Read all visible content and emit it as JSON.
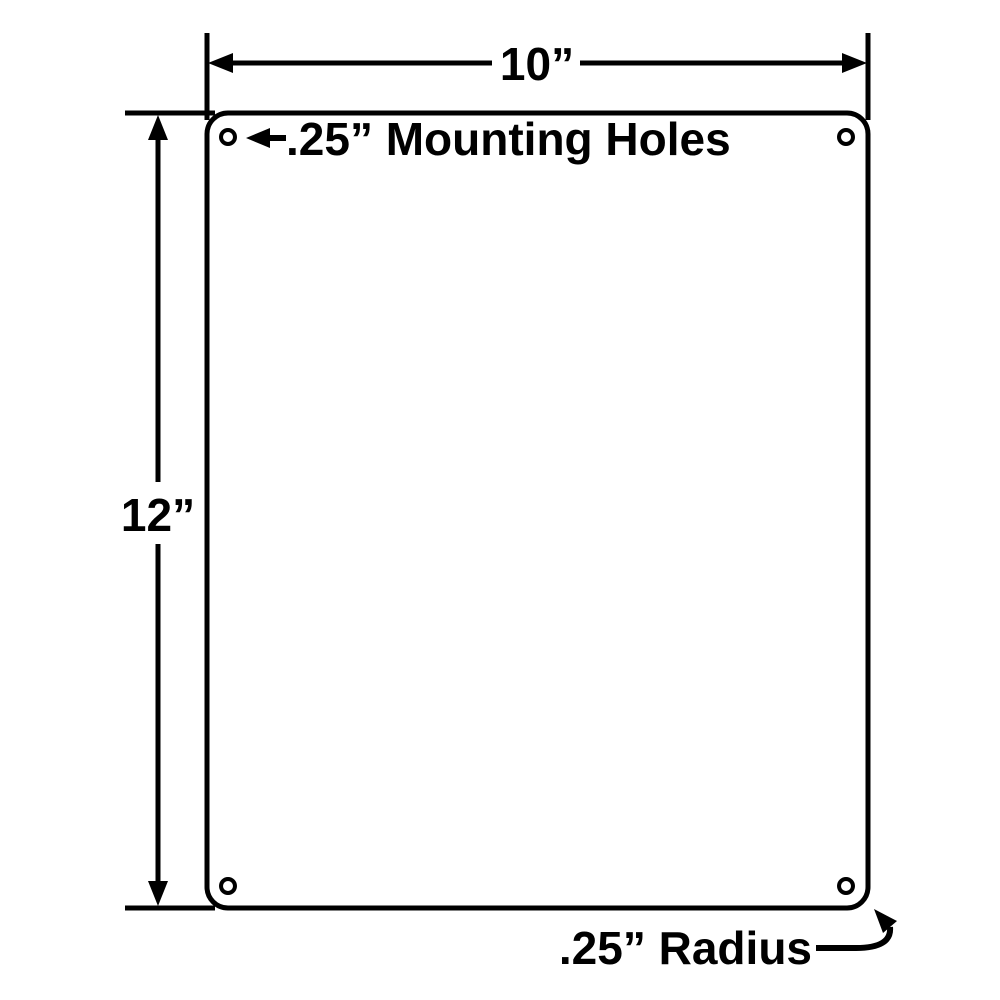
{
  "drawing": {
    "description": "Dimensional diagram of a blank rectangular sign plate with rounded corners and mounting holes",
    "width_label": "10”",
    "height_label": "12”",
    "mounting_holes_label": ".25” Mounting Holes",
    "radius_label": ".25” Radius",
    "mounting_hole_count": 4,
    "colors": {
      "line": "#000000",
      "background": "#ffffff",
      "plate_fill": "#ffffff"
    }
  }
}
